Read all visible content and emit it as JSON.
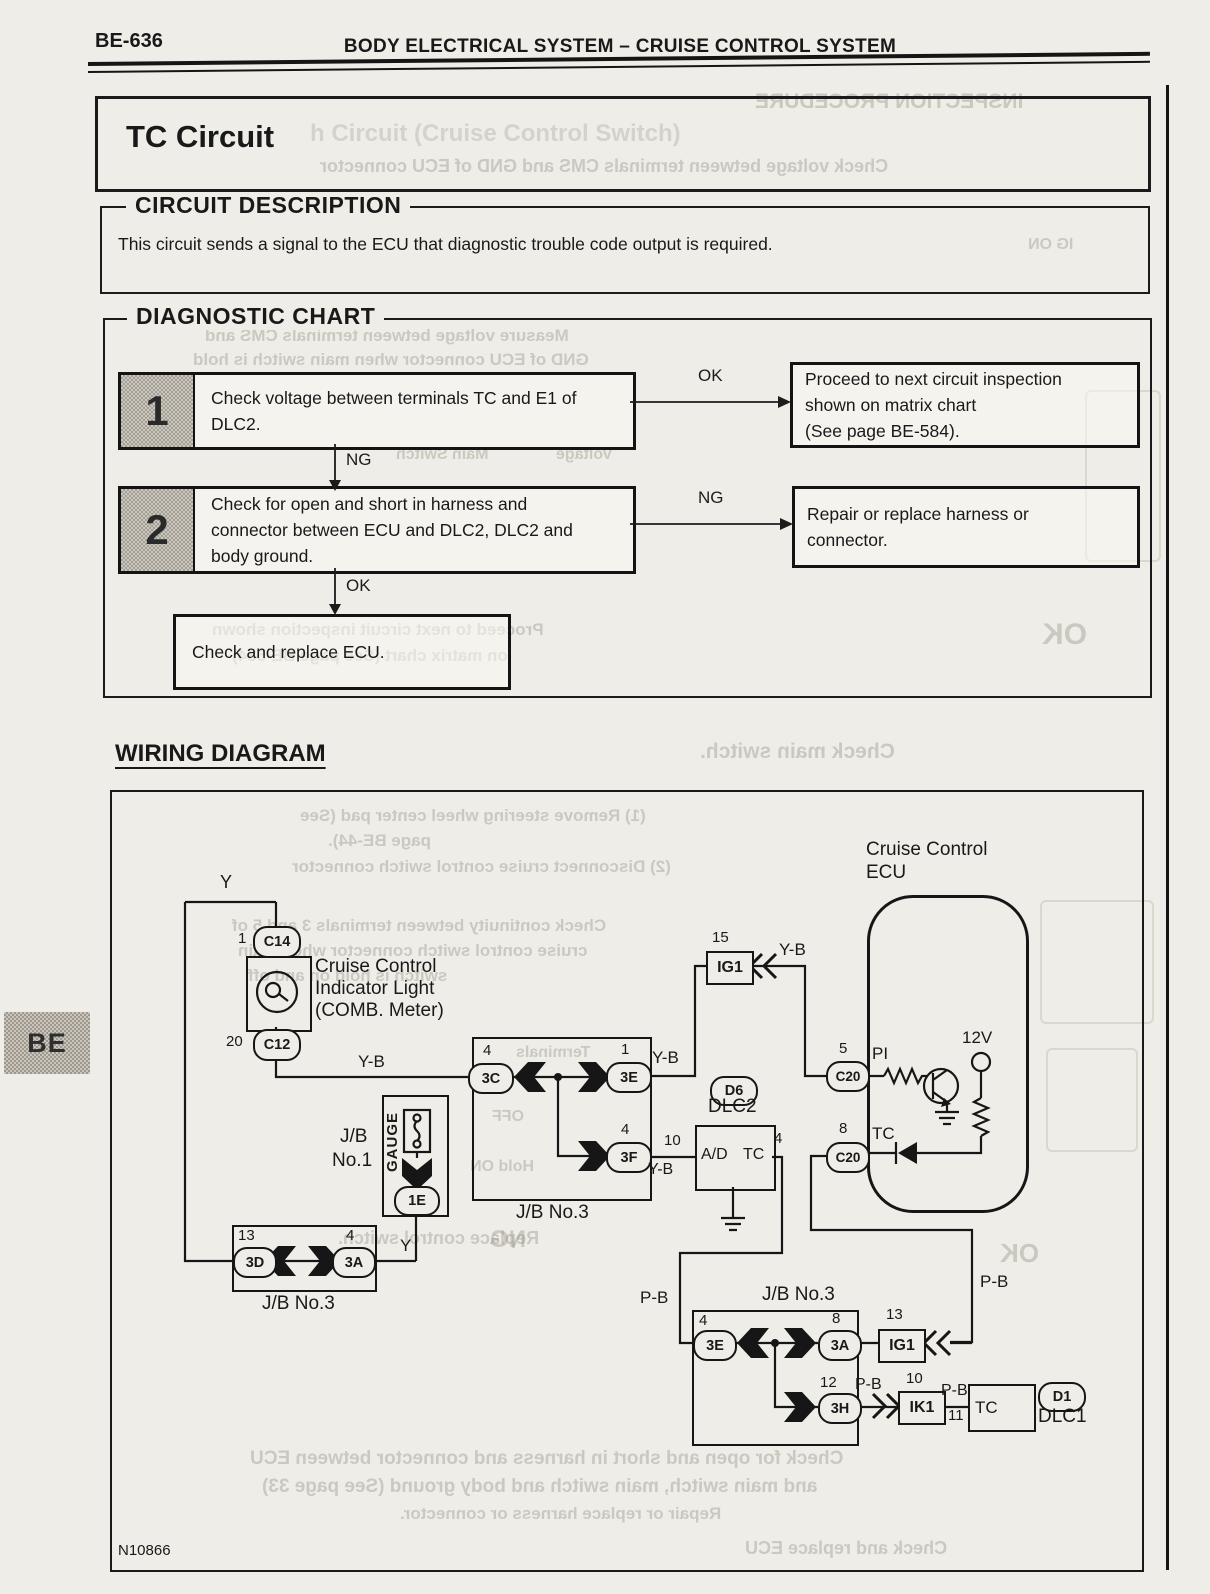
{
  "page": {
    "code": "BE-636",
    "header": "BODY ELECTRICAL SYSTEM – CRUISE CONTROL SYSTEM",
    "title": "TC Circuit",
    "side_tab": "BE",
    "figure_code": "N10866"
  },
  "circuit_description": {
    "heading": "CIRCUIT DESCRIPTION",
    "body": "This circuit sends a signal to the ECU that diagnostic trouble code output is required."
  },
  "diagnostic_chart": {
    "heading": "DIAGNOSTIC CHART",
    "step1": {
      "num": "1",
      "line1": "Check voltage between terminals TC and E1 of",
      "line2": "DLC2.",
      "branch": "OK",
      "result1": "Proceed to next circuit inspection",
      "result2": "shown on matrix chart",
      "result3": "(See page BE-584).",
      "down": "NG"
    },
    "step2": {
      "num": "2",
      "line1": "Check for open and short in harness and",
      "line2": "connector between ECU and DLC2, DLC2 and",
      "line3": "body ground.",
      "branch": "NG",
      "result1": "Repair or replace harness or",
      "result2": "connector.",
      "down": "OK"
    },
    "final": "Check and replace ECU."
  },
  "wiring": {
    "heading": "WIRING DIAGRAM",
    "y_top": "Y",
    "c14_pin": "1",
    "c14": "C14",
    "ind1": "Cruise Control",
    "ind2": "Indicator Light",
    "ind3": "(COMB. Meter)",
    "c12_pin": "20",
    "c12": "C12",
    "yb1": "Y-B",
    "jb3m_pin3c": "4",
    "jb3m_3c": "3C",
    "jb3m_pin3e": "1",
    "jb3m_3e": "3E",
    "jb3m_pin3f": "4",
    "jb3m_3f": "3F",
    "jb3m_label": "J/B No.3",
    "yb2": "Y-B",
    "ig1t_pin": "15",
    "ig1t": "IG1",
    "ig1t_wire": "Y-B",
    "ecu1": "Cruise Control",
    "ecu2": "ECU",
    "c20a_pin": "5",
    "c20a": "C20",
    "pi": "PI",
    "v12": "12V",
    "c20b_pin": "8",
    "c20b": "C20",
    "tc_ecu": "TC",
    "d6": "D6",
    "dlc2": "DLC2",
    "dlc2_pin10": "10",
    "dlc2_yb": "Y-B",
    "dlc2_ad": "A/D",
    "dlc2_tc": "TC",
    "dlc2_pin4": "4",
    "jb1_l1": "J/B",
    "jb1_l2": "No.1",
    "gauge": "GAUGE",
    "e1": "1E",
    "y_mid": "Y",
    "jb3bl_pin3d": "13",
    "jb3bl_3d": "3D",
    "jb3bl_pin3a": "4",
    "jb3bl_3a": "3A",
    "jb3bl_label": "J/B No.3",
    "pb_left": "P-B",
    "jb3b_label": "J/B No.3",
    "jb3b_pin3e": "4",
    "jb3b_3e": "3E",
    "jb3b_pin3a": "8",
    "jb3b_3a": "3A",
    "jb3b_pin3h": "12",
    "jb3b_3h": "3H",
    "pb_right": "P-B",
    "ig1b_pin": "13",
    "ig1b": "IG1",
    "pb_mid": "P-B",
    "ik1_pin": "10",
    "ik1": "IK1",
    "pb_out": "P-B",
    "pin11": "11",
    "dlc1_tc": "TC",
    "d1": "D1",
    "dlc1": "DLC1"
  },
  "bleed": {
    "items": [
      "INSPECTION PROCEDURE",
      "h Circuit (Cruise Control Switch)",
      "Check voltage between terminals CMS and GND of ECU connector",
      "IG ON",
      "Measure voltage between terminals CMS and",
      "GND of ECU connector when main switch is hold",
      "Main Switch",
      "Voltage",
      "Proceed to next circuit inspection shown",
      "on matrix chart (See page BE-584)",
      "OK",
      "Check main switch.",
      "(1) Remove steering wheel center pad (See",
      "page BE-44).",
      "(2) Disconnect cruise control switch connector",
      "Check continuity between terminals 3 and 5 of",
      "cruise control switch connector when main",
      "switch is hold on and off",
      "Terminals",
      "OFF",
      "Hold ON",
      "Replace control switch.",
      "NG",
      "OK",
      "Check for open and short in harness and connector between ECU",
      "and main switch, main switch and body ground (See page 33)",
      "Repair or replace harness or connector.",
      "Check and replace ECU"
    ]
  }
}
